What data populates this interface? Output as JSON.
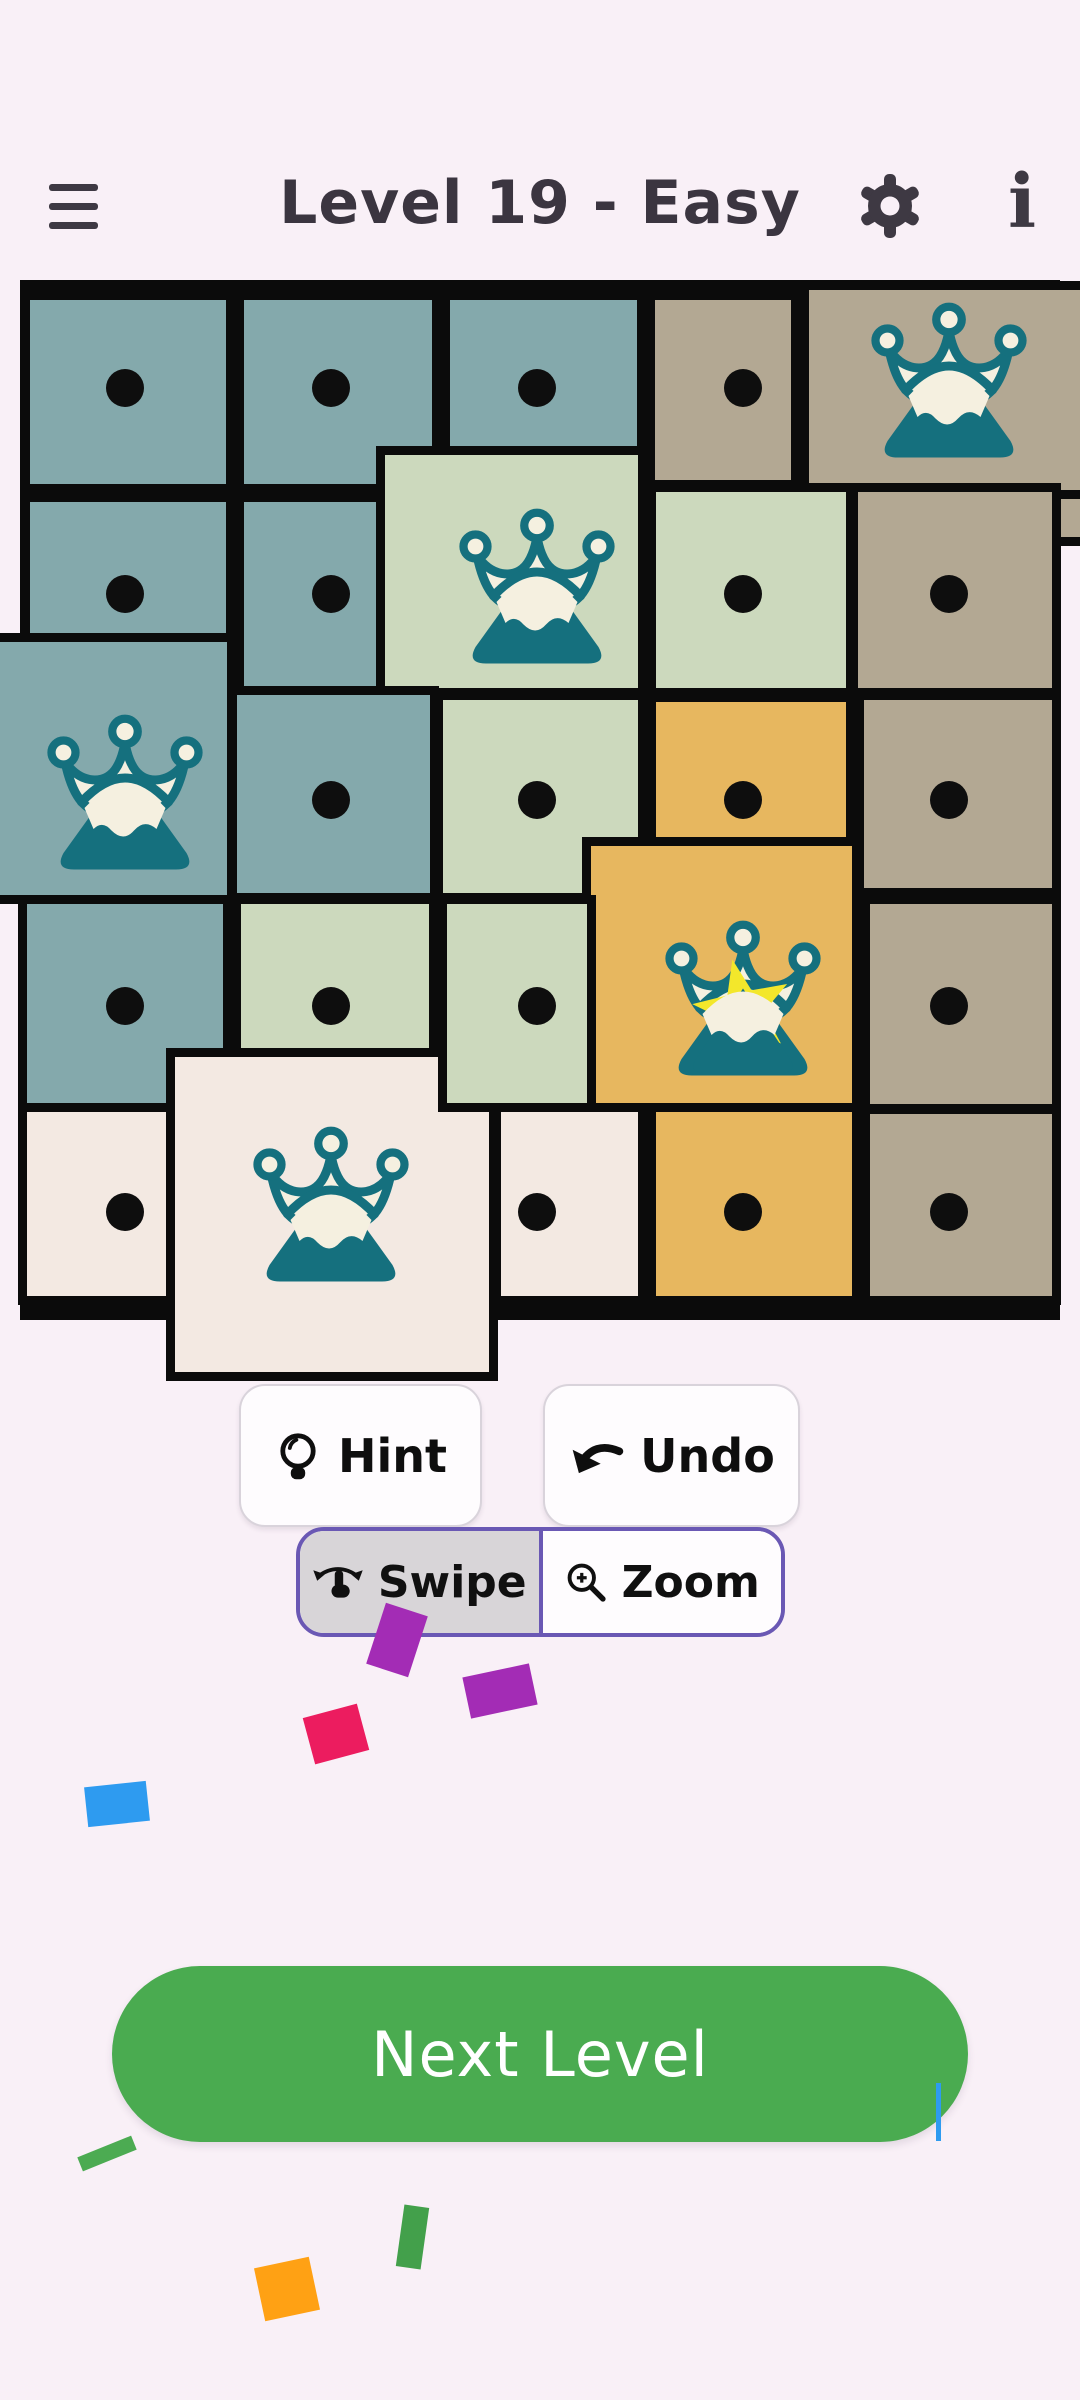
{
  "header": {
    "title": "Level 19 - Easy"
  },
  "controls": {
    "hint_label": "Hint",
    "undo_label": "Undo",
    "swipe_label": "Swipe",
    "zoom_label": "Zoom",
    "selected_mode": "Swipe",
    "next_level_label": "Next Level"
  },
  "theme": {
    "background": "#f9f0f7",
    "line": "#0b0b0b",
    "title_text": "#3b3540",
    "icon": "#3e3943",
    "dot": "#0e0e0e",
    "purple": "#6a58b4",
    "segment_gray": "#d8d5d8",
    "next_green": "#4aab50",
    "button_border": "#d9d3db",
    "button_text": "#0e0e0e"
  },
  "board": {
    "rows": 5,
    "cols": 5,
    "centers_x": [
      125,
      331,
      537,
      743,
      949
    ],
    "centers_y": [
      388,
      594,
      800,
      1006,
      1212
    ],
    "cells": [
      [
        "dot",
        "dot",
        "dot",
        "dot",
        "crown"
      ],
      [
        "dot",
        "dot",
        "crown",
        "dot",
        "dot"
      ],
      [
        "crown",
        "dot",
        "dot",
        "dot",
        "dot"
      ],
      [
        "dot",
        "dot",
        "dot",
        "crown-star",
        "dot"
      ],
      [
        "dot",
        "crown",
        "dot",
        "dot",
        "dot"
      ]
    ],
    "colors": {
      "teal": "#84a9ac",
      "green": "#ccd9bd",
      "tan": "#b3a893",
      "orange": "#e7b75f",
      "cream": "#f3e9e2",
      "crown_teal": "#15707e",
      "crown_white": "#f5f0e0",
      "star": "#f3e72b"
    },
    "tiles": [
      {
        "x": 30,
        "y": 300,
        "w": 196,
        "h": 184,
        "color": "teal"
      },
      {
        "x": 244,
        "y": 300,
        "w": 188,
        "h": 184,
        "color": "teal"
      },
      {
        "x": 450,
        "y": 300,
        "w": 187,
        "h": 146,
        "color": "teal"
      },
      {
        "x": 655,
        "y": 300,
        "w": 136,
        "h": 180,
        "color": "tan"
      },
      {
        "x": 809,
        "y": 290,
        "w": 271,
        "h": 200,
        "color": "tan"
      },
      {
        "x": 1058,
        "y": 499,
        "w": 22,
        "h": 38,
        "color": "tan"
      },
      {
        "x": 30,
        "y": 502,
        "w": 196,
        "h": 184,
        "color": "teal"
      },
      {
        "x": 244,
        "y": 502,
        "w": 138,
        "h": 184,
        "color": "teal"
      },
      {
        "x": 385,
        "y": 455,
        "w": 253,
        "h": 233,
        "color": "green"
      },
      {
        "x": 656,
        "y": 492,
        "w": 190,
        "h": 196,
        "color": "green"
      },
      {
        "x": 858,
        "y": 492,
        "w": 194,
        "h": 196,
        "color": "tan"
      },
      {
        "x": 0,
        "y": 642,
        "w": 227,
        "h": 253,
        "color": "teal"
      },
      {
        "x": 237,
        "y": 695,
        "w": 193,
        "h": 198,
        "color": "teal"
      },
      {
        "x": 443,
        "y": 700,
        "w": 195,
        "h": 193,
        "color": "green"
      },
      {
        "x": 656,
        "y": 702,
        "w": 190,
        "h": 138,
        "color": "orange"
      },
      {
        "x": 864,
        "y": 700,
        "w": 188,
        "h": 188,
        "color": "tan"
      },
      {
        "x": 27,
        "y": 904,
        "w": 196,
        "h": 201,
        "color": "teal"
      },
      {
        "x": 241,
        "y": 904,
        "w": 188,
        "h": 144,
        "color": "green"
      },
      {
        "x": 591,
        "y": 846,
        "w": 261,
        "h": 259,
        "color": "orange"
      },
      {
        "x": 870,
        "y": 904,
        "w": 182,
        "h": 200,
        "color": "tan"
      },
      {
        "x": 27,
        "y": 1112,
        "w": 144,
        "h": 184,
        "color": "cream"
      },
      {
        "x": 175,
        "y": 1057,
        "w": 314,
        "h": 315,
        "color": "cream"
      },
      {
        "x": 447,
        "y": 904,
        "w": 140,
        "h": 199,
        "color": "green"
      },
      {
        "x": 501,
        "y": 1112,
        "w": 137,
        "h": 184,
        "color": "cream"
      },
      {
        "x": 656,
        "y": 1112,
        "w": 196,
        "h": 184,
        "color": "orange"
      },
      {
        "x": 870,
        "y": 1114,
        "w": 182,
        "h": 182,
        "color": "tan"
      }
    ]
  },
  "confetti": [
    {
      "x": 375,
      "y": 1608,
      "w": 44,
      "h": 64,
      "rot": 18,
      "color": "#a32cb5"
    },
    {
      "x": 466,
      "y": 1670,
      "w": 68,
      "h": 42,
      "rot": -12,
      "color": "#a32cb5"
    },
    {
      "x": 308,
      "y": 1710,
      "w": 56,
      "h": 48,
      "rot": -15,
      "color": "#ec1c5f"
    },
    {
      "x": 86,
      "y": 1784,
      "w": 62,
      "h": 40,
      "rot": -6,
      "color": "#2e9bf0"
    },
    {
      "x": 78,
      "y": 2146,
      "w": 58,
      "h": 15,
      "rot": -22,
      "color": "#4cab52"
    },
    {
      "x": 400,
      "y": 2206,
      "w": 25,
      "h": 62,
      "rot": 8,
      "color": "#43a04b"
    },
    {
      "x": 259,
      "y": 2262,
      "w": 56,
      "h": 54,
      "rot": -12,
      "color": "#ffa114"
    },
    {
      "x": 936,
      "y": 2083,
      "w": 5,
      "h": 58,
      "rot": 0,
      "color": "#2e9bf0"
    }
  ]
}
